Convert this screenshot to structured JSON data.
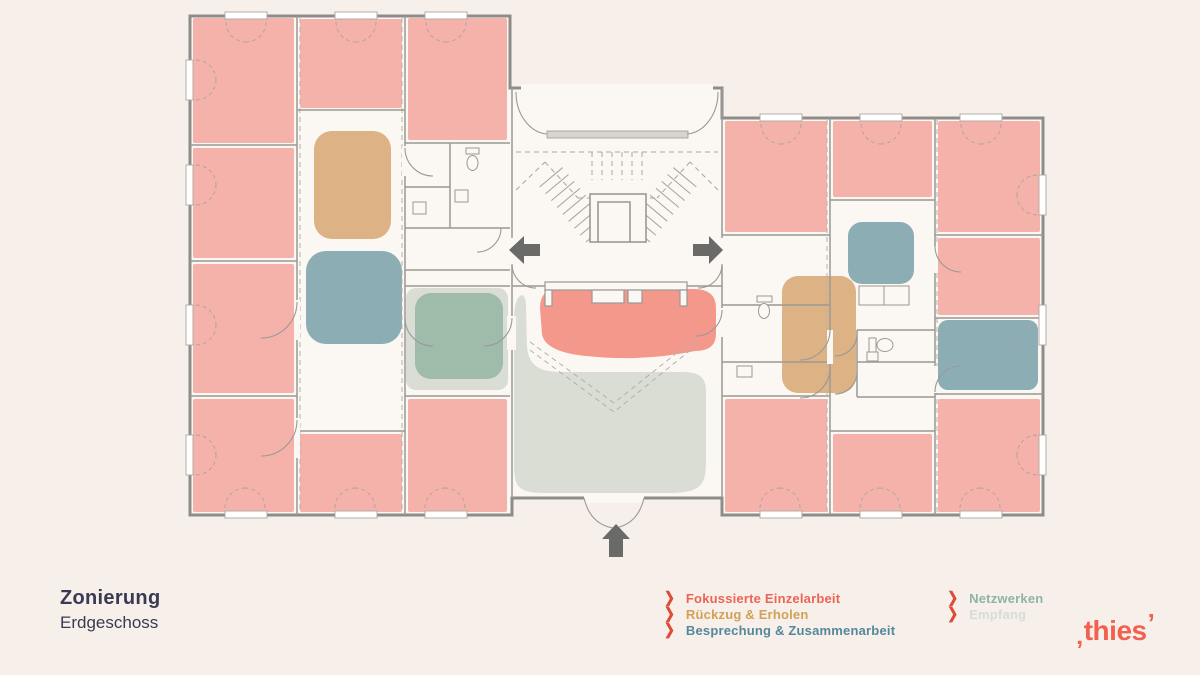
{
  "slide": {
    "background": "#F7F0EA",
    "title": "Zonierung",
    "subtitle": "Erdgeschoss"
  },
  "legend": {
    "marker": "❯",
    "marker_color": "#E04A38",
    "columns": [
      {
        "items": [
          {
            "label": "Fokussierte Einzelarbeit",
            "color": "#EE6454"
          },
          {
            "label": "Rückzug & Erholen",
            "color": "#D2A057"
          },
          {
            "label": "Besprechung & Zusammenarbeit",
            "color": "#55879A"
          }
        ]
      },
      {
        "items": [
          {
            "label": "Netzwerken",
            "color": "#8FB4A4"
          },
          {
            "label": "Empfang",
            "color": "#D7DCD6"
          }
        ]
      }
    ]
  },
  "logo": {
    "text": "thies",
    "color": "#F2604F",
    "left_mark": "‚",
    "right_mark": "’"
  },
  "floorplan": {
    "label": "Grundriss Erdgeschoss",
    "floor_color": "#FBF7F3",
    "wall_color": "#8E8C88",
    "line_color": "#9B9995",
    "arrow_color": "#6A6A68",
    "zones": {
      "focus": {
        "label": "Fokussierte Einzelarbeit",
        "fill": "#F5B2AB",
        "accent": "#F4988B"
      },
      "retreat": {
        "label": "Rückzug & Erholen",
        "fill": "#DDB385"
      },
      "meeting": {
        "label": "Besprechung & Zusammenarbeit",
        "fill": "#8CADB4"
      },
      "network": {
        "label": "Netzwerken",
        "fill": "#9FBCAB"
      },
      "reception": {
        "label": "Empfang",
        "fill": "#D9DDD4"
      }
    }
  }
}
